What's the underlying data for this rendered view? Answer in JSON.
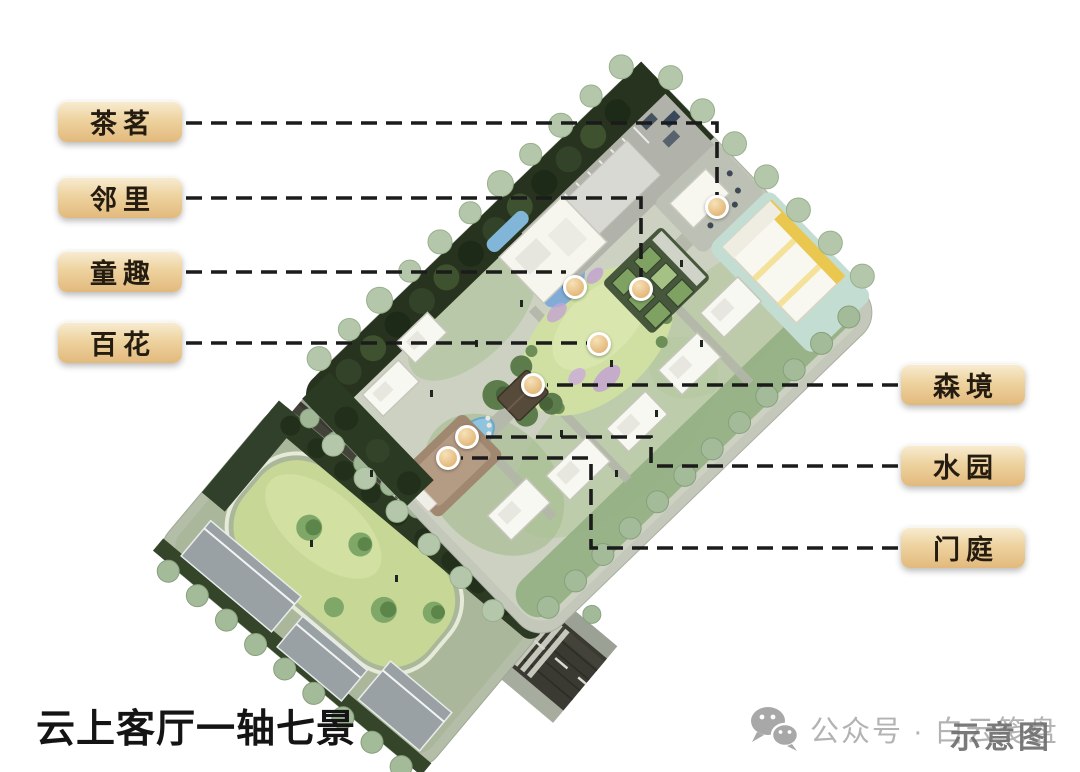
{
  "title": "云上客厅一轴七景",
  "watermark": {
    "icon": "wechat-icon",
    "account_text": "公众号 · 白云笺盘",
    "stamp_text": "示意图"
  },
  "legend_style": {
    "label_bg_top": "#f8edd3",
    "label_bg_mid": "#eed3a0",
    "label_bg_bottom": "#e2b97c",
    "label_text": "#241c10",
    "leader_color": "#1b1b1b",
    "marker_ring": "#ffffff",
    "marker_fill_light": "#f6e2b8",
    "marker_fill_dark": "#dfae6b"
  },
  "annotations": [
    {
      "label": "茶茗",
      "name": "tea-court",
      "side": "left",
      "box": {
        "x": 58,
        "y": 101
      },
      "line": [
        [
          186,
          123
        ],
        [
          717,
          123
        ],
        [
          717,
          195
        ]
      ],
      "marker": [
        717,
        207
      ]
    },
    {
      "label": "邻里",
      "name": "neighborhood-garden",
      "side": "left",
      "box": {
        "x": 58,
        "y": 177
      },
      "line": [
        [
          186,
          198
        ],
        [
          641,
          198
        ],
        [
          641,
          277
        ]
      ],
      "marker": [
        641,
        289
      ]
    },
    {
      "label": "童趣",
      "name": "kids-play",
      "side": "left",
      "box": {
        "x": 58,
        "y": 251
      },
      "line": [
        [
          186,
          272
        ],
        [
          566,
          272
        ]
      ],
      "marker": [
        575,
        287
      ]
    },
    {
      "label": "百花",
      "name": "flower-lawn",
      "side": "left",
      "box": {
        "x": 58,
        "y": 322
      },
      "line": [
        [
          186,
          343
        ],
        [
          587,
          343
        ]
      ],
      "marker": [
        599,
        344
      ]
    },
    {
      "label": "森境",
      "name": "forest-court",
      "side": "right",
      "box": {
        "x": 901,
        "y": 364
      },
      "line": [
        [
          898,
          385
        ],
        [
          547,
          385
        ]
      ],
      "marker": [
        533,
        385
      ]
    },
    {
      "label": "水园",
      "name": "water-garden",
      "side": "right",
      "box": {
        "x": 901,
        "y": 445
      },
      "line": [
        [
          898,
          466
        ],
        [
          651,
          466
        ],
        [
          651,
          437
        ],
        [
          480,
          437
        ]
      ],
      "marker": [
        467,
        437
      ]
    },
    {
      "label": "门庭",
      "name": "entry-court",
      "side": "right",
      "box": {
        "x": 901,
        "y": 527
      },
      "line": [
        [
          898,
          548
        ],
        [
          591,
          548
        ],
        [
          591,
          458
        ],
        [
          461,
          458
        ]
      ],
      "marker": [
        448,
        458
      ]
    }
  ]
}
